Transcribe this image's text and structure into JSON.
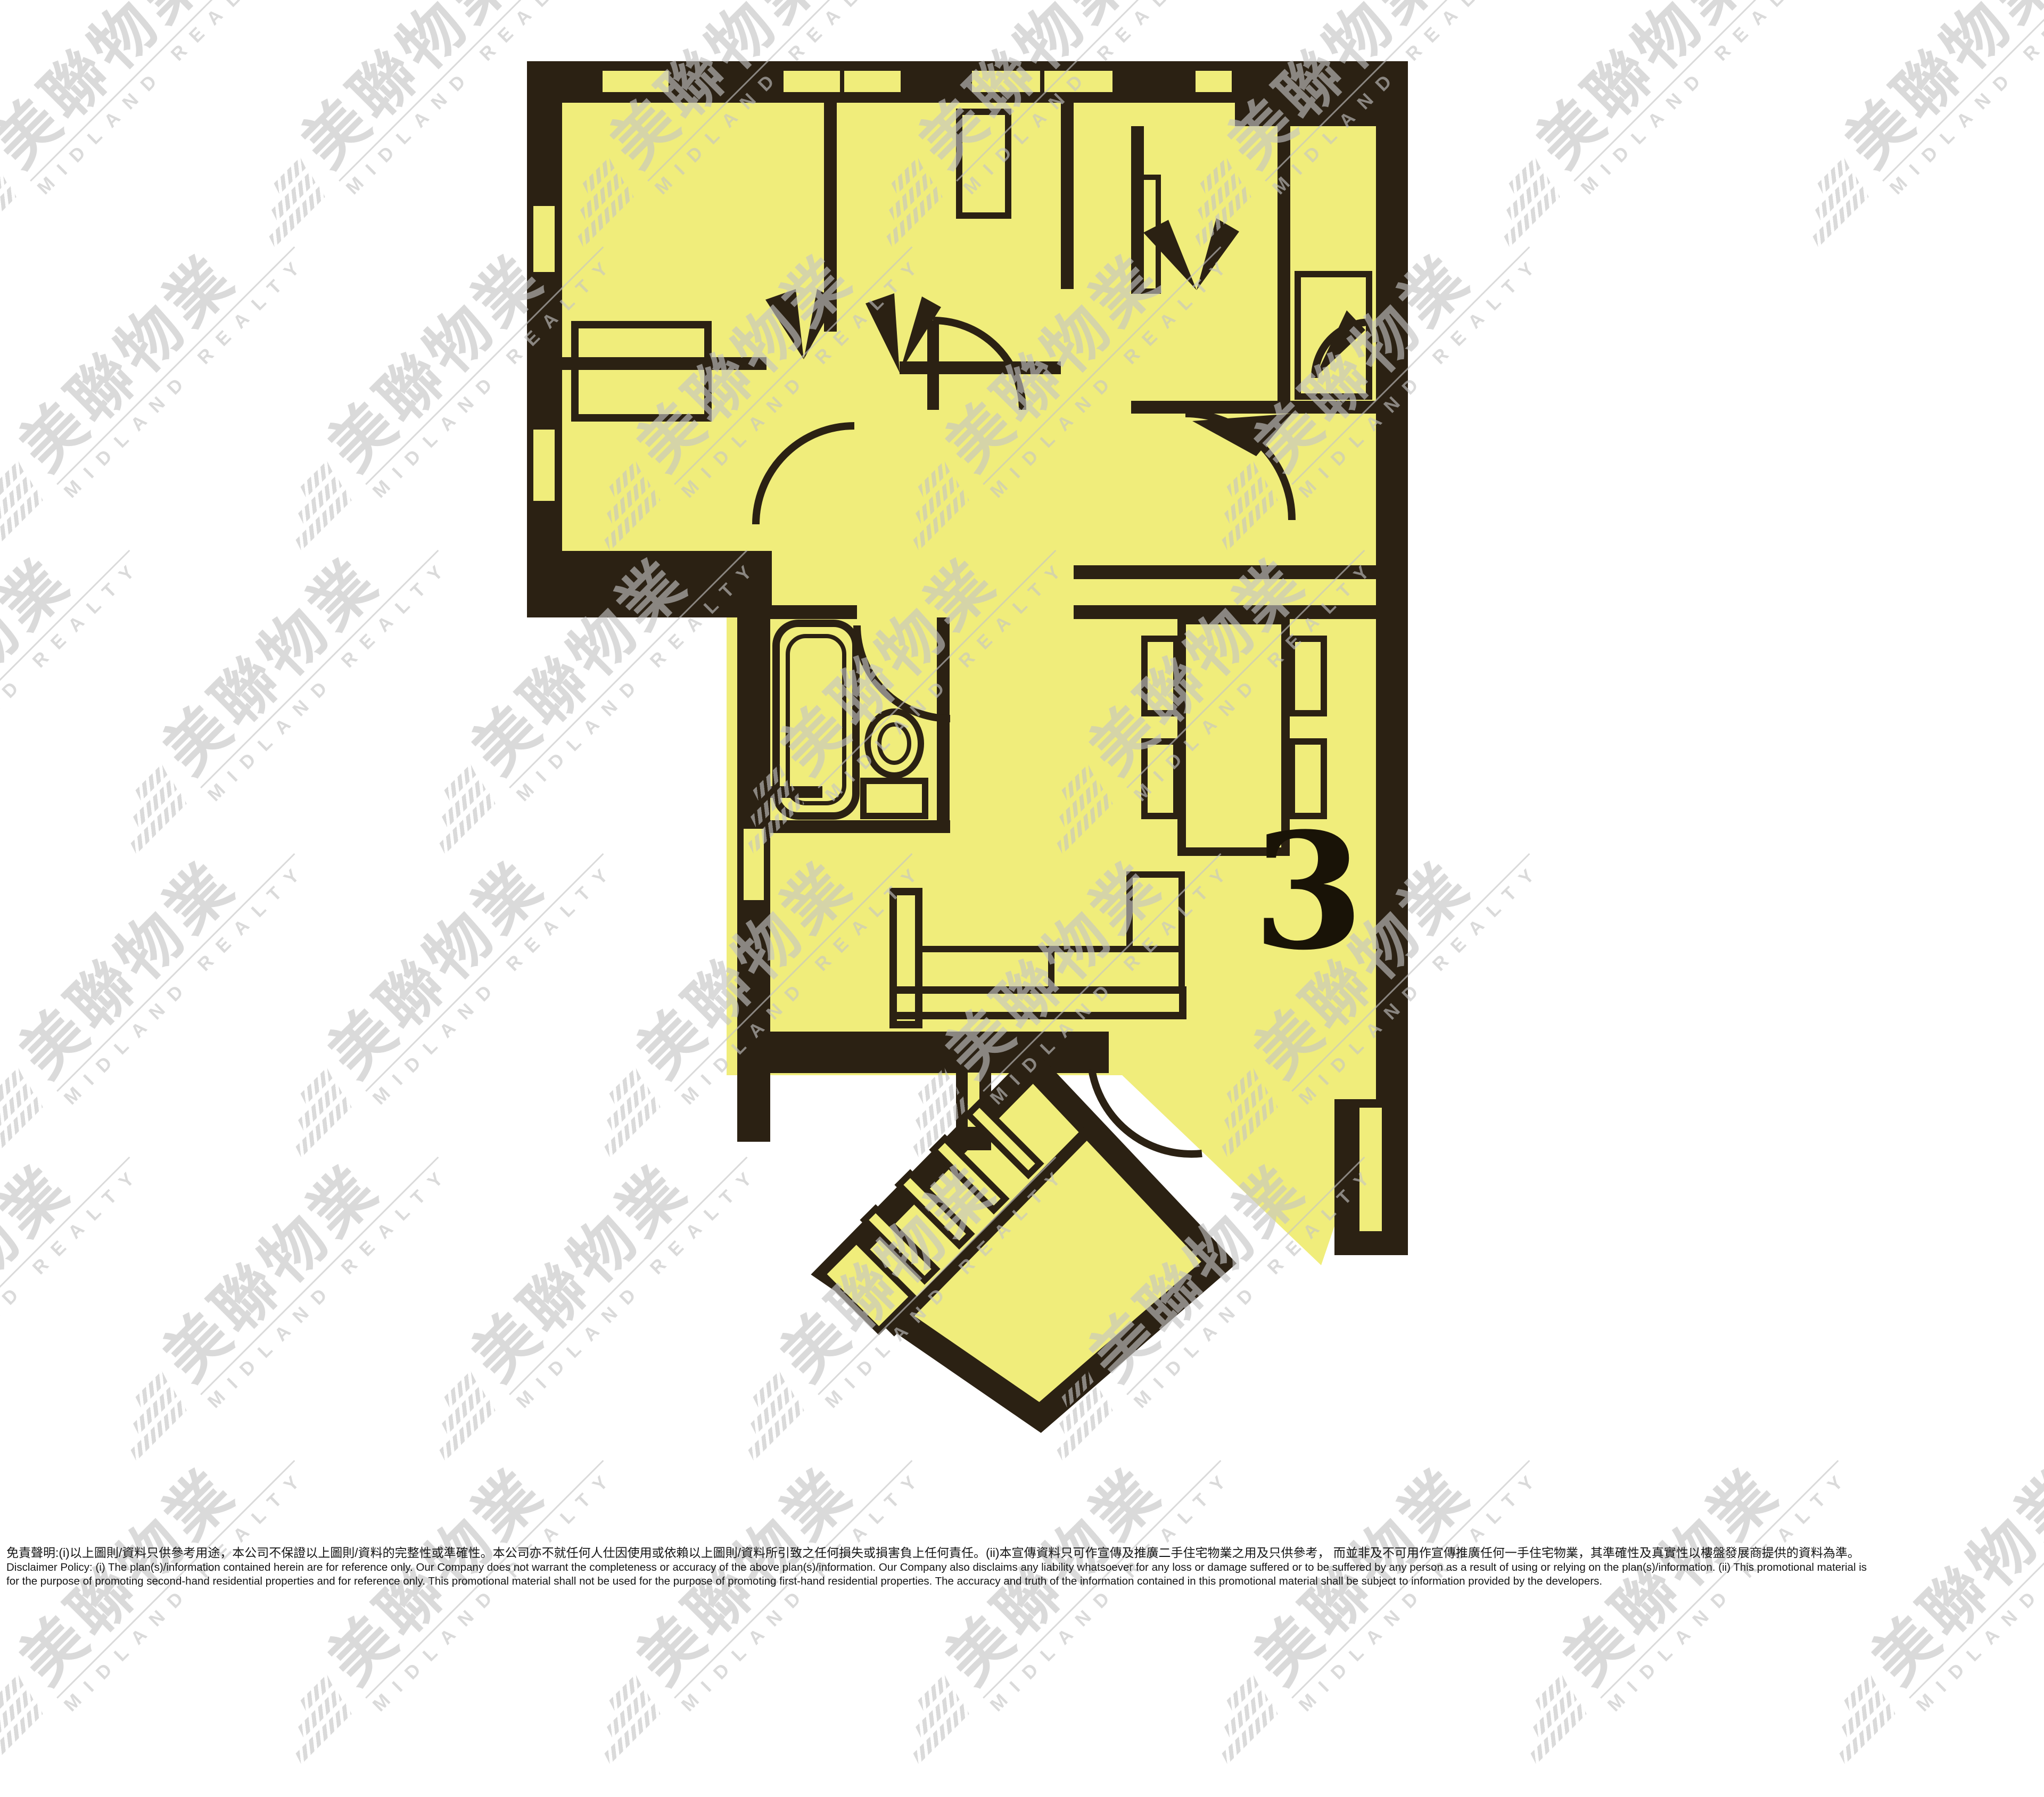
{
  "floor_plan": {
    "unit_number": "3",
    "colors": {
      "floor_yellow": "#f0ed7b",
      "wall_dark": "#2b2113",
      "background": "#ffffff",
      "watermark_gray": "#c5c5c5"
    },
    "fixtures": [
      "bathtub-icon",
      "toilet-icon",
      "dining-table",
      "dining-chair",
      "l-sofa",
      "bed-block",
      "wardrobe",
      "stairs-icon",
      "door-swing-arc",
      "door-wedge",
      "window-slot",
      "entrance-door-arc",
      "lift-lobby-diamond"
    ]
  },
  "watermark": {
    "text_zh": "美聯物業",
    "text_en": "MIDLAND REALTY"
  },
  "disclaimer": {
    "line_zh": "免責聲明:(i)以上圖則/資料只供參考用途，本公司不保證以上圖則/資料的完整性或準確性。本公司亦不就任何人仕因使用或依賴以上圖則/資料所引致之任何損失或損害負上任何責任。(ii)本宣傳資料只可作宣傳及推廣二手住宅物業之用及只供參考， 而並非及不可用作宣傳推廣任何一手住宅物業，其準確性及真實性以樓盤發展商提供的資料為準。",
    "line_en_1": "Disclaimer Policy: (i) The plan(s)/information contained herein are for reference only. Our Company does not warrant the completeness or accuracy of the above plan(s)/information. Our Company also disclaims any liability whatsoever for any loss or damage suffered or to be suffered by any person as a result of using or relying on the plan(s)/information. (ii) This promotional material is",
    "line_en_2": "for the purpose of promoting second-hand residential properties and for reference only. This promotional material shall not be used for the purpose of promoting first-hand residential properties. The accuracy and truth of the information contained in this promotional material shall be subject to information provided by the developers."
  }
}
